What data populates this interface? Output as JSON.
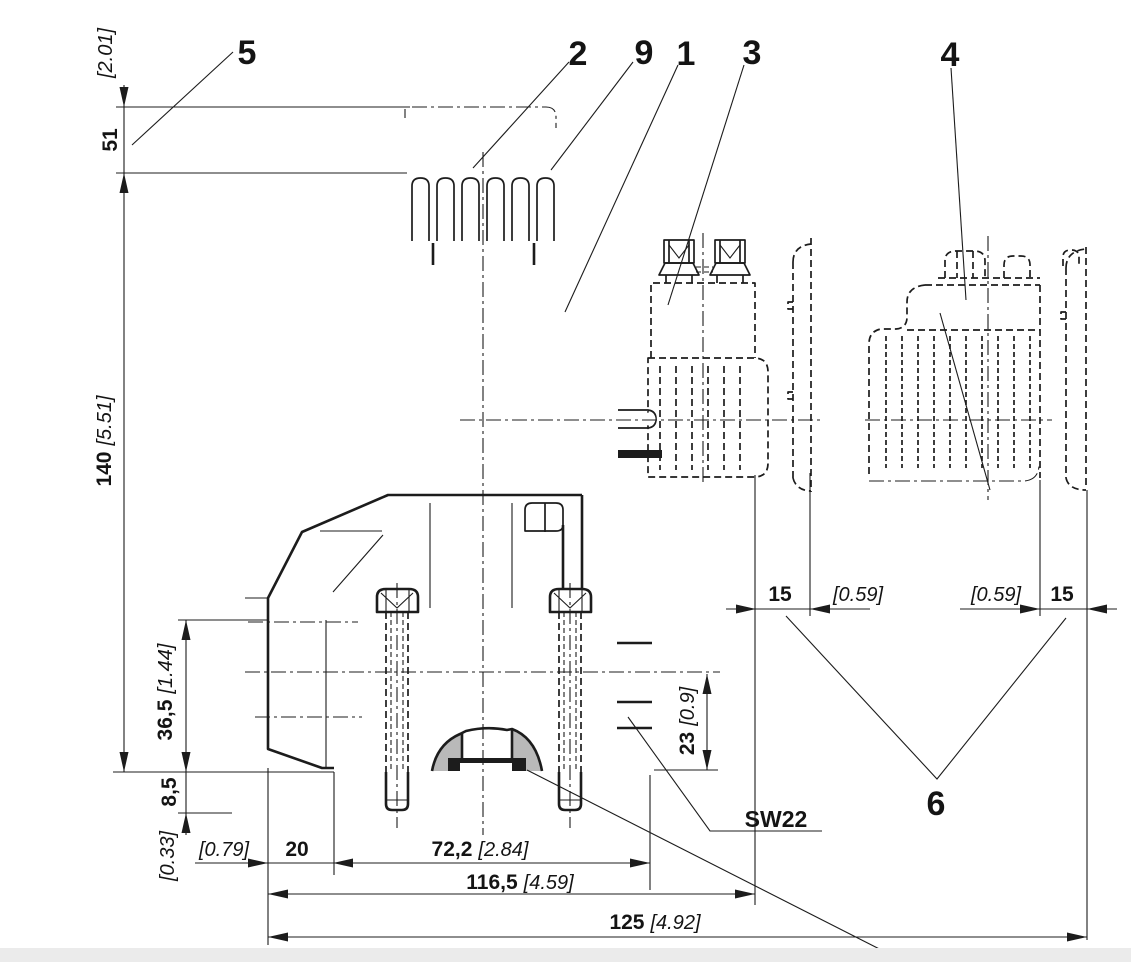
{
  "drawing": {
    "callouts": {
      "c5": "5",
      "c2": "2",
      "c9": "9",
      "c1": "1",
      "c3": "3",
      "c4": "4",
      "c6": "6"
    },
    "dimensions": {
      "raise_in": "[2.01]",
      "raise_mm": "51",
      "height_mm": "140",
      "height_in": "[5.51]",
      "port_mm": "36,5",
      "port_in": "[1.44]",
      "stud_mm": "8,5",
      "stud_in": "[0.33]",
      "offset_in": "[0.79]",
      "offset_mm": "20",
      "spacing_mm": "72,2",
      "spacing_in": "[2.84]",
      "width_mm": "116,5",
      "width_in": "[4.59]",
      "overall_mm": "125",
      "overall_in": "[4.92]",
      "removal_left_mm": "15",
      "removal_left_in": "[0.59]",
      "removal_right_in": "[0.59]",
      "removal_right_mm": "15",
      "axis_mm": "23",
      "axis_in": "[0.9]",
      "wrench": "SW22"
    },
    "colors": {
      "line": "#1c1c1c",
      "shade": "#b9b9b9",
      "background": "#ffffff",
      "footer": "#ebebeb"
    }
  }
}
